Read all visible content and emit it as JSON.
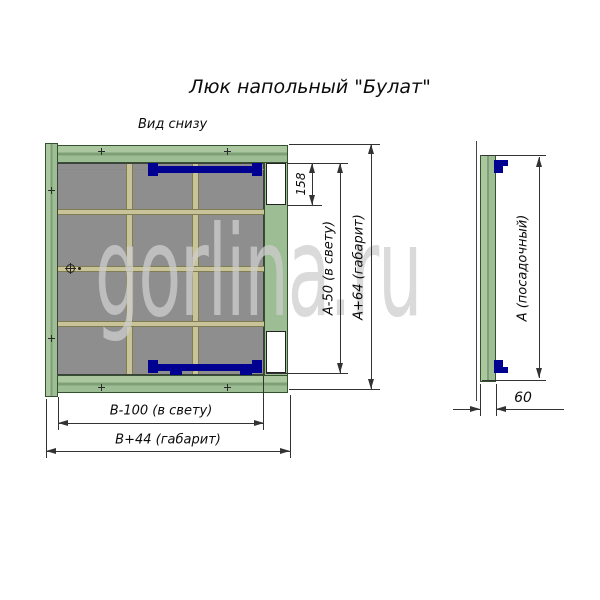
{
  "title": "Люк напольный \"Булат\"",
  "view_label": "Вид снизу",
  "watermark": "gorlina.ru",
  "main_view": {
    "dim_cutout": "158",
    "dim_clear_height": "А-50 (в свету)",
    "dim_overall_height": "А+64 (габарит)",
    "dim_clear_width": "В-100 (в свету)",
    "dim_overall_width": "В+44 (габарит)"
  },
  "side_view": {
    "dim_seat": "А (посадочный)",
    "dim_depth": "60"
  },
  "colors": {
    "frame-green": "#9dbd94",
    "frame-green-hi": "#aac7a0",
    "frame-green-mid": "#7fa077",
    "frame-green-dark": "#33512f",
    "panel-gray": "#8e8e8e",
    "panel-border": "#3f3f3f",
    "rib-tan": "#c9c399",
    "rib-border": "#807d52",
    "hinge-navy": "#000091",
    "line-color": "#333333"
  }
}
